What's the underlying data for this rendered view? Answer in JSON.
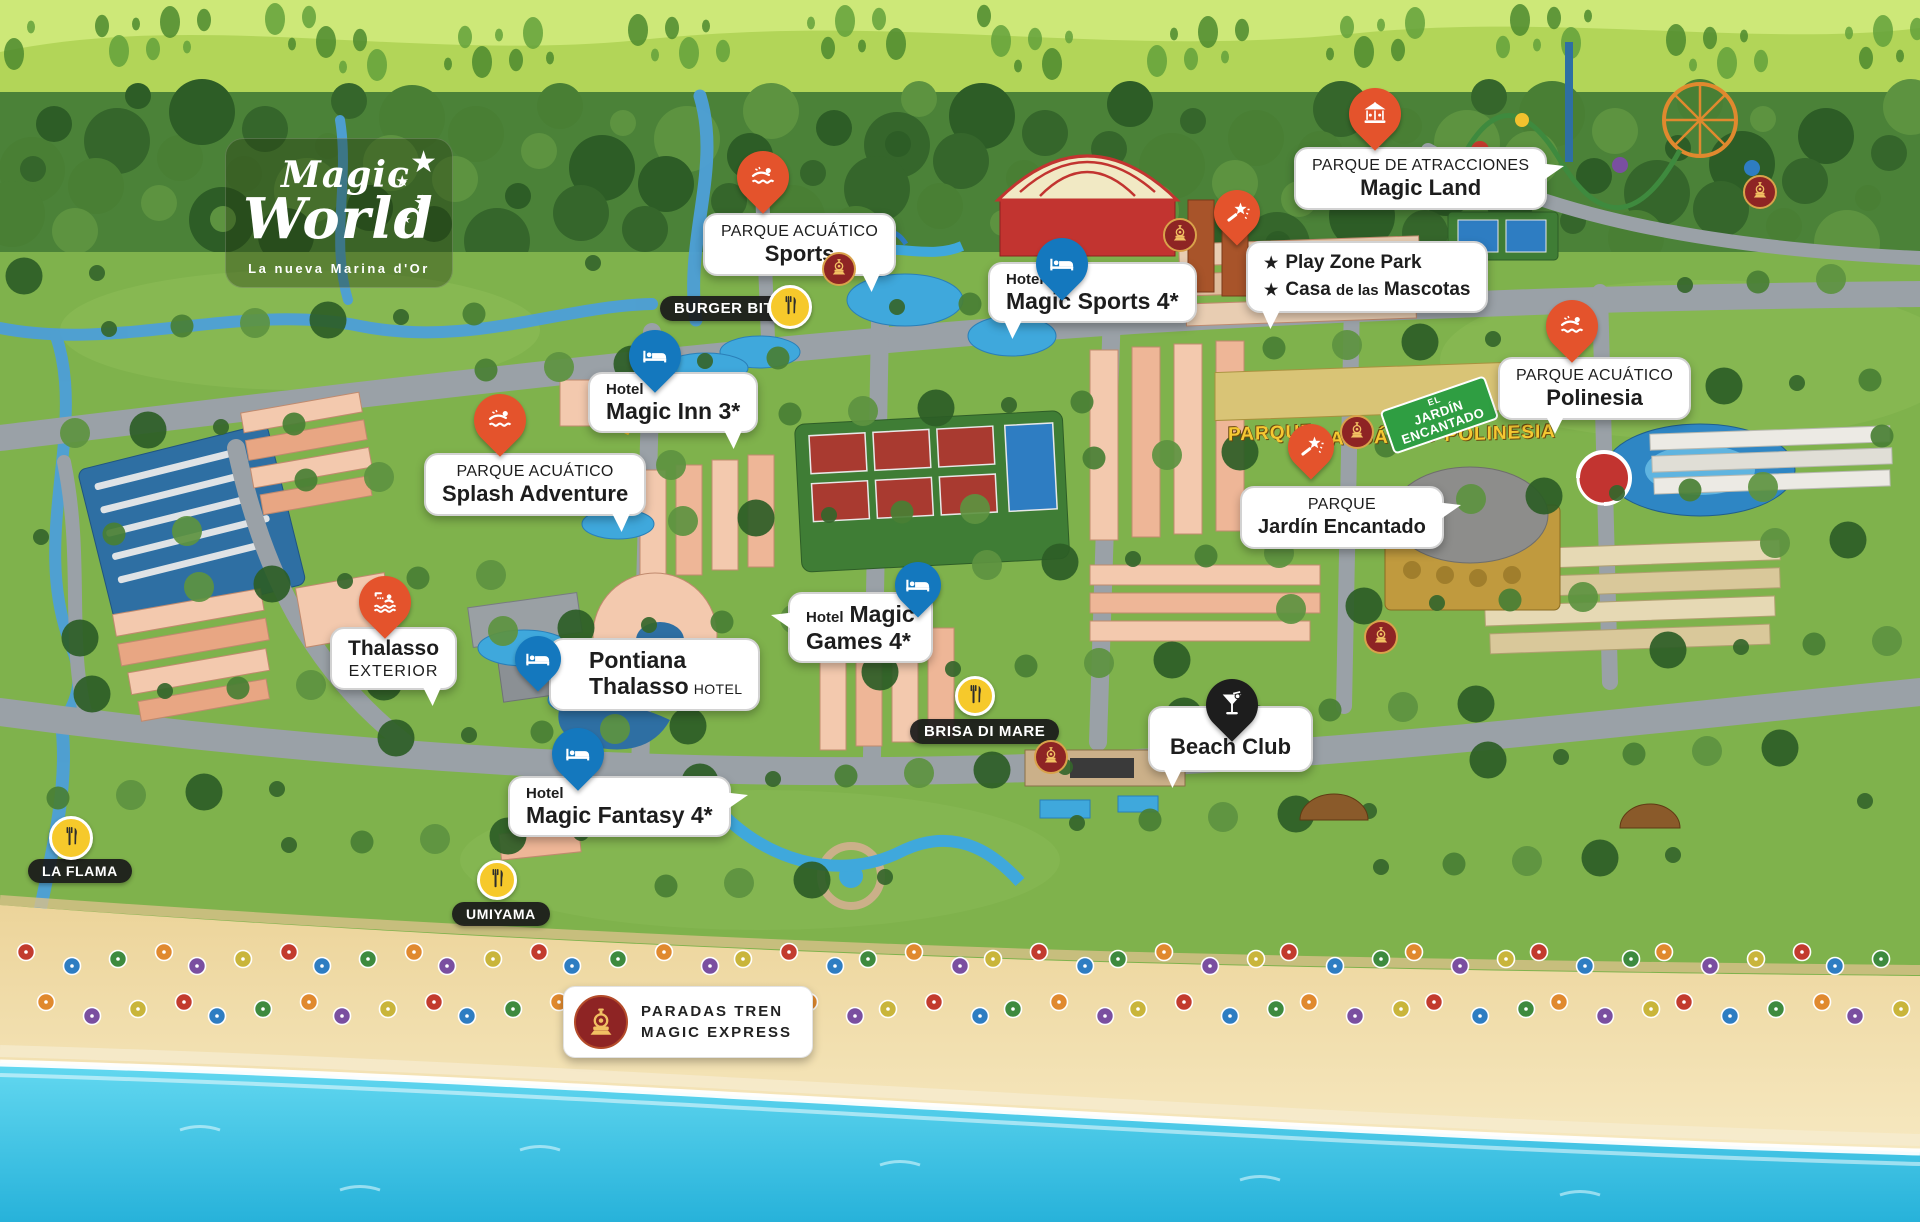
{
  "logo": {
    "word1": "Magic",
    "word2": "World",
    "star": "★",
    "subtitle": "La nueva Marina d'Or"
  },
  "markers": {
    "sports": {
      "icon": "swimmer-icon",
      "line1": "PARQUE ACUÁTICO",
      "line2": "Sports"
    },
    "splash": {
      "icon": "swimmer-icon",
      "line1": "PARQUE ACUÁTICO",
      "line2": "Splash Adventure"
    },
    "polinesia": {
      "icon": "swimmer-icon",
      "line1": "PARQUE ACUÁTICO",
      "line2": "Polinesia"
    },
    "magic_land": {
      "icon": "carousel-icon",
      "line1": "PARQUE DE ATRACCIONES",
      "line2": "Magic Land"
    },
    "jardin": {
      "icon": "magic-wand-icon",
      "line1": "PARQUE",
      "line2": "Jardín Encantado"
    },
    "play_zone": {
      "icon": "magic-wand-icon",
      "star": "★",
      "line1": "Play Zone Park",
      "line2_a": "Casa",
      "line2_b": "de las",
      "line2_c": "Mascotas"
    },
    "thalasso": {
      "icon": "shower-swim-icon",
      "line1": "Thalasso",
      "line2": "EXTERIOR"
    },
    "magic_sports": {
      "icon": "bed-icon",
      "small": "Hotel",
      "name": "Magic Sports 4*"
    },
    "magic_inn": {
      "icon": "bed-icon",
      "small": "Hotel",
      "name": "Magic Inn 3*"
    },
    "magic_fantasy": {
      "icon": "bed-icon",
      "small": "Hotel",
      "name": "Magic Fantasy 4*"
    },
    "magic_games": {
      "icon": "bed-icon",
      "small": "Hotel",
      "line1b": "Magic",
      "line2": "Games 4*"
    },
    "pontiana": {
      "icon": "bed-icon",
      "line1": "Pontiana",
      "line2": "Thalasso",
      "suffix": "HOTEL"
    },
    "beach_club": {
      "icon": "cocktail-icon",
      "label": "Beach Club"
    }
  },
  "food": {
    "burger_bites": {
      "icon": "fork-knife-icon",
      "label": "BURGER BITES"
    },
    "brisa_di_mare": {
      "icon": "fork-knife-icon",
      "label": "BRISA DI MARE"
    },
    "la_flama": {
      "icon": "fork-knife-icon",
      "label": "LA FLAMA"
    },
    "umiyama": {
      "icon": "fork-knife-icon",
      "label": "UMIYAMA"
    }
  },
  "legend": {
    "icon": "train-icon",
    "line1": "PARADAS TREN",
    "line2": "MAGIC EXPRESS"
  },
  "signs": {
    "parque": "PARQUE",
    "acuatico_polinesia": "ACUÁTICO POLINESIA",
    "el": "EL",
    "jardin": "JARDÍN",
    "encantado": "ENCANTADO"
  },
  "colors": {
    "pin_orange": "#e4532c",
    "pin_blue": "#1478be",
    "pin_black": "#1d1d1d",
    "food_yellow": "#f6c92b",
    "train_red": "#8e2424",
    "bubble_border": "#d2d2d2",
    "sea": "#3cc7e8",
    "sand": "#f0dba4",
    "grass": "#7fb24c",
    "road": "#9aa1a7"
  }
}
